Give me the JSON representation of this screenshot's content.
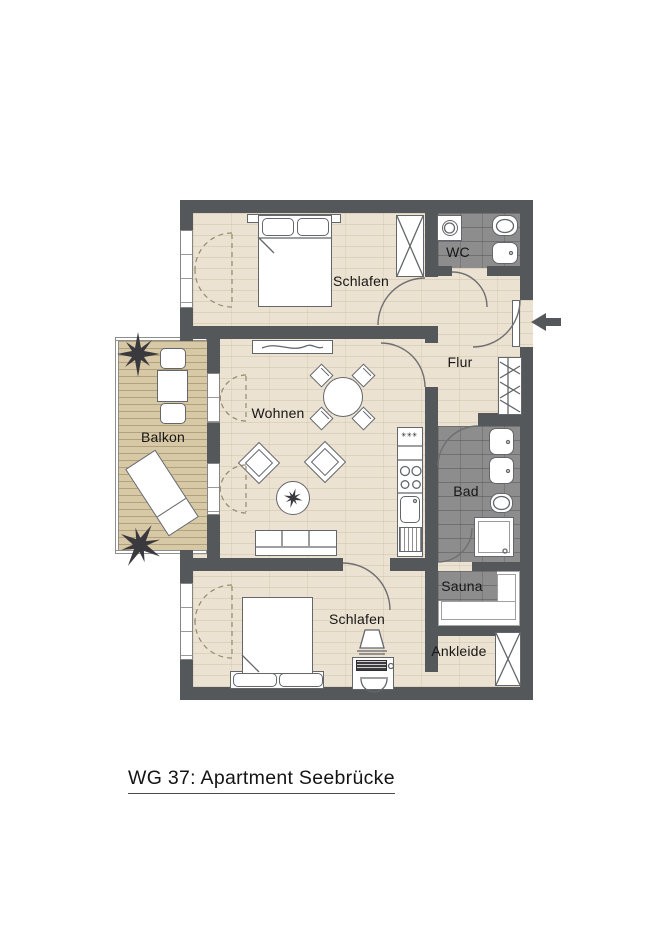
{
  "title": "WG 37: Apartment Seebrücke",
  "rooms": {
    "schlafen_top": "Schlafen",
    "wc": "WC",
    "flur": "Flur",
    "wohnen": "Wohnen",
    "balkon": "Balkon",
    "bad": "Bad",
    "sauna": "Sauna",
    "schlafen_bottom": "Schlafen",
    "ankleide": "Ankleide"
  },
  "kitchen": {
    "freezer_symbol": "✳✳✳"
  },
  "entrance": {
    "arrow_icon": "arrow-left"
  },
  "colors": {
    "wall": "#54585b",
    "floor": "#ebe2d1",
    "tile": "#8d8d8d",
    "deck": "#d7c8a6",
    "line": "#63666a",
    "text": "#161616"
  }
}
